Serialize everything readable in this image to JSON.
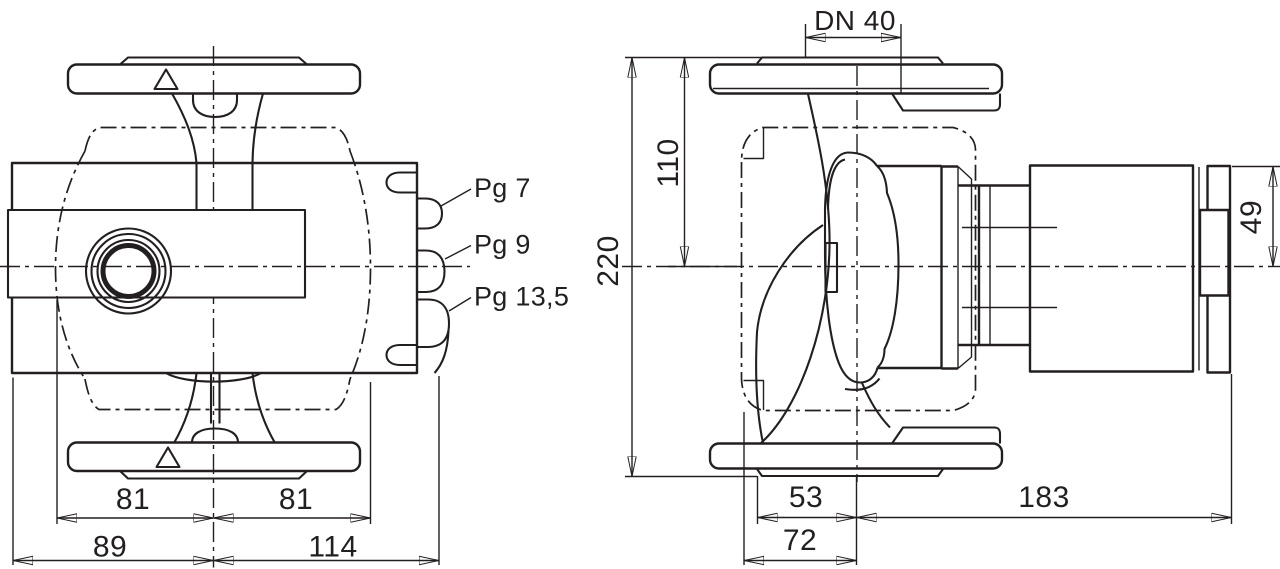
{
  "drawing": {
    "background": "#ffffff",
    "ink": "#231f20",
    "front_view": {
      "gland_labels": {
        "pg7": "Pg 7",
        "pg9": "Pg 9",
        "pg13_5": "Pg 13,5"
      },
      "dims": {
        "half_width_left": "81",
        "half_width_right": "81",
        "width_left": "89",
        "width_right": "114"
      }
    },
    "side_view": {
      "dims": {
        "nominal_diameter": "DN 40",
        "top_to_axis": "110",
        "overall_height": "220",
        "motor_top_to_axis": "49",
        "axis_to_flange": "53",
        "axis_to_edge": "72",
        "axis_to_motor_end": "183"
      }
    }
  }
}
